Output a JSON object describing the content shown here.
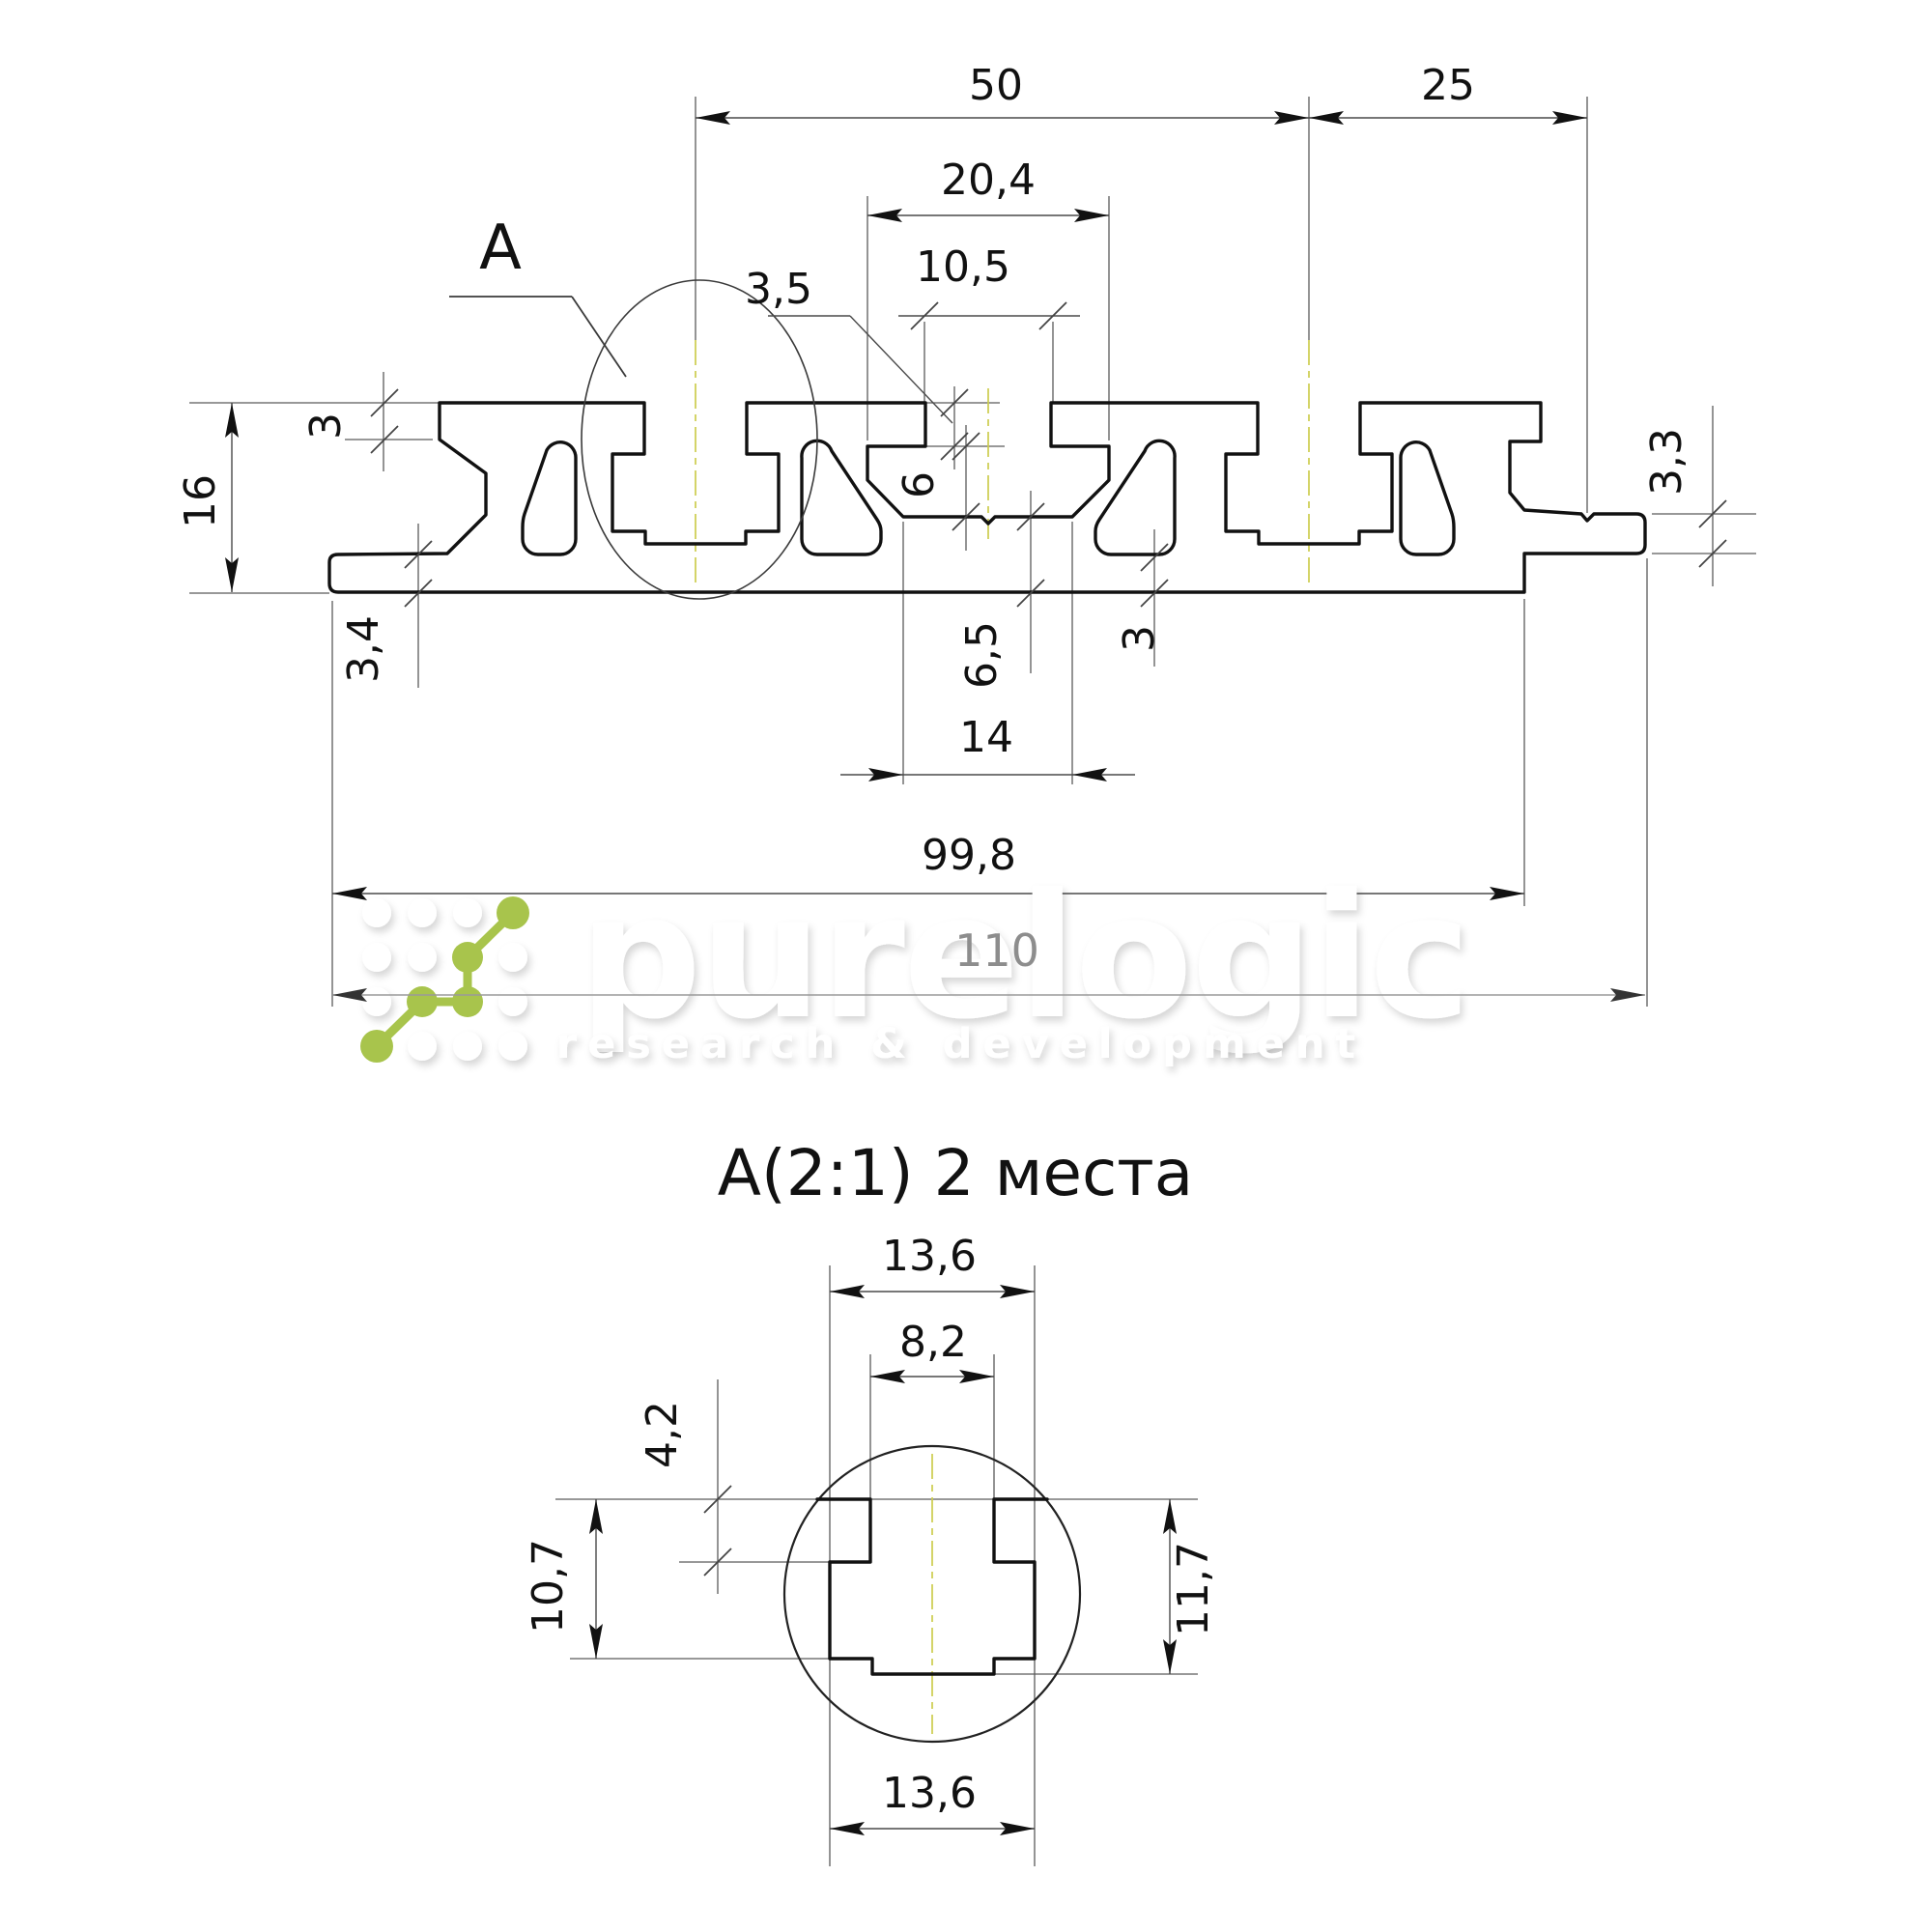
{
  "watermark": {
    "brand": "purelogic",
    "tagline": "research & development",
    "green": "#a8c44c"
  },
  "detail": {
    "title": "A(2:1) 2 места",
    "ref_label": "A"
  },
  "dims": {
    "w50": "50",
    "w25": "25",
    "w204": "20,4",
    "w105": "10,5",
    "w35": "3,5",
    "h3": "3",
    "h16": "16",
    "h34": "3,4",
    "h33": "3,3",
    "v6": "6",
    "v65": "6,5",
    "v3mid": "3",
    "w14": "14",
    "w998": "99,8",
    "w110": "110",
    "d136_top": "13,6",
    "d82": "8,2",
    "d42": "4,2",
    "d107": "10,7",
    "d117": "11,7",
    "d136_bottom": "13,6"
  },
  "colors": {
    "centerline": "#cdcd4e",
    "dim_faint": "#9a9a9a",
    "line": "#111111"
  }
}
